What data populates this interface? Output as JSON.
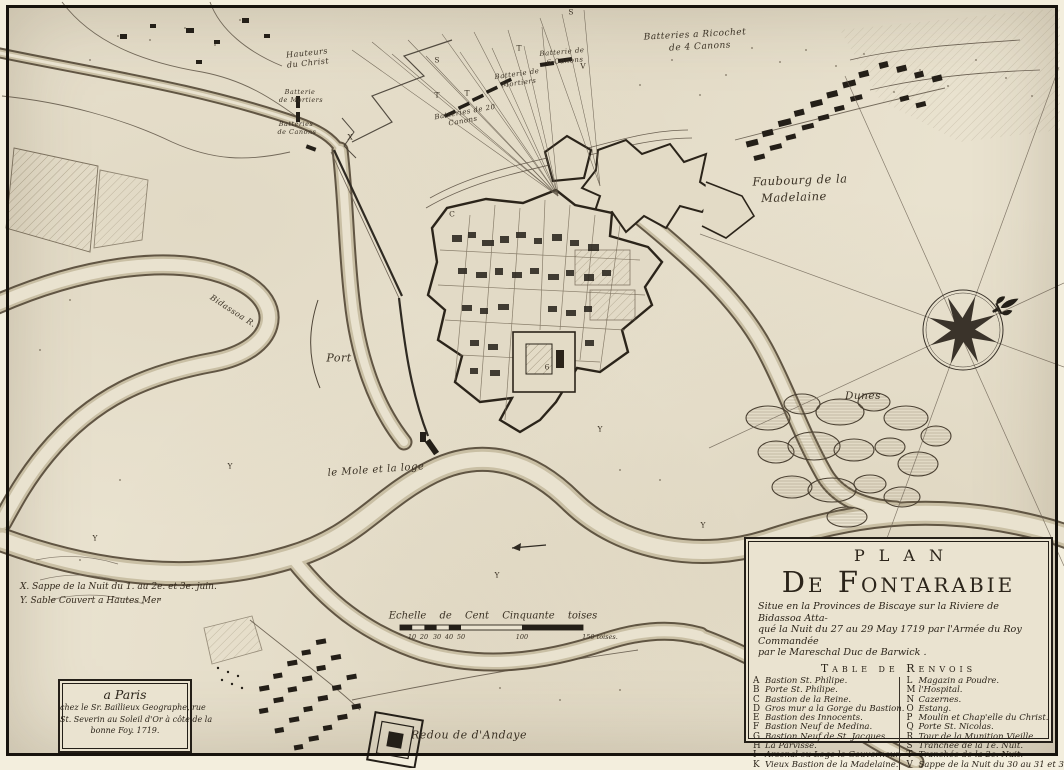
{
  "title_block": {
    "line1": "Plan",
    "line2": "De Fontarabie",
    "subtitle": [
      "Situe en la Provinces de Biscaye sur la Riviere de Bidassoa Atta-",
      "qué la Nuit du 27 au 29 May 1719 par l'Armée du Roy Commandée",
      "par le Mareschal Duc de Barwick ."
    ],
    "table_title": "Table de Renvois",
    "left_entries": [
      {
        "key": "A",
        "label": "Bastion St. Philipe."
      },
      {
        "key": "B",
        "label": "Porte St. Philipe."
      },
      {
        "key": "C",
        "label": "Bastion de la Reine."
      },
      {
        "key": "D",
        "label": "Gros mur a la Gorge du Bastion."
      },
      {
        "key": "E",
        "label": "Bastion des Innocents."
      },
      {
        "key": "F",
        "label": "Bastion Neuf de Medina."
      },
      {
        "key": "G",
        "label": "Bastion Neuf de St. Jacques."
      },
      {
        "key": "H",
        "label": "La Parvisse."
      },
      {
        "key": "I",
        "label": "Arsenal ou Loge le Gouverneur."
      },
      {
        "key": "K",
        "label": "Vieux Bastion de la Madelaine."
      }
    ],
    "right_entries": [
      {
        "key": "L",
        "label": "Magazin a Poudre."
      },
      {
        "key": "M",
        "label": "l'Hospital."
      },
      {
        "key": "N",
        "label": "Cazernes."
      },
      {
        "key": "O",
        "label": "Estang."
      },
      {
        "key": "P",
        "label": "Moulin et Chap'elle du Christ."
      },
      {
        "key": "Q",
        "label": "Porte St. Nicolas."
      },
      {
        "key": "R",
        "label": "Tour de la Munition Vieille."
      },
      {
        "key": "S",
        "label": "Tranchée de la 1e. Nuit."
      },
      {
        "key": "T",
        "label": "Tranchée de la 2e. Nuit."
      },
      {
        "key": "V",
        "label": "Sappe de la Nuit du 30 au 31 et 3 juin."
      }
    ]
  },
  "publisher_block": {
    "line1": "a Paris",
    "line2": "chez le Sr. Baillieux  Geographe, rue",
    "line3": "St. Severin au Soleil d'Or à côte de la",
    "line4": "bonne Foy. 1719."
  },
  "notes": {
    "x_note": "X. Sappe de la Nuit du 1. au 2e. et 3e. juin.",
    "y_note": "Y. Sable Couvert a Hautes Mer"
  },
  "scale_bar": {
    "label": "Echelle de Cent Cinquante toises",
    "ticks": [
      {
        "t": "10",
        "x": 412,
        "y": 633
      },
      {
        "t": "20",
        "x": 424,
        "y": 633
      },
      {
        "t": "30",
        "x": 437,
        "y": 633
      },
      {
        "t": "40",
        "x": 449,
        "y": 633
      },
      {
        "t": "50",
        "x": 461,
        "y": 633
      },
      {
        "t": "100",
        "x": 522,
        "y": 633
      },
      {
        "t": "150 toises.",
        "x": 600,
        "y": 633
      }
    ]
  },
  "map_labels": [
    {
      "text": "Batteries a Ricochet",
      "x": 695,
      "y": 35,
      "size": 9,
      "rot": -3
    },
    {
      "text": "de 4 Canons",
      "x": 700,
      "y": 47,
      "size": 9,
      "rot": -3
    },
    {
      "text": "Hauteurs",
      "x": 307,
      "y": 53,
      "size": 8,
      "rot": -6
    },
    {
      "text": "du Christ",
      "x": 308,
      "y": 63,
      "size": 8,
      "rot": -6
    },
    {
      "text": "Batterie",
      "x": 300,
      "y": 92,
      "size": 6.5,
      "rot": 0
    },
    {
      "text": "de Mortiers",
      "x": 301,
      "y": 100,
      "size": 6.5,
      "rot": 0
    },
    {
      "text": "Batteries",
      "x": 296,
      "y": 124,
      "size": 6.5,
      "rot": 0
    },
    {
      "text": "de Canons",
      "x": 297,
      "y": 132,
      "size": 6.5,
      "rot": 0
    },
    {
      "text": "Batterie de",
      "x": 562,
      "y": 52,
      "size": 7,
      "rot": -5
    },
    {
      "text": "6 Canons",
      "x": 565,
      "y": 61,
      "size": 7,
      "rot": -5
    },
    {
      "text": "Batterie de",
      "x": 517,
      "y": 74,
      "size": 7,
      "rot": -8
    },
    {
      "text": "Mortiers",
      "x": 519,
      "y": 83,
      "size": 7,
      "rot": -8
    },
    {
      "text": "Batteries de 20",
      "x": 465,
      "y": 112,
      "size": 7,
      "rot": -10
    },
    {
      "text": "Canons",
      "x": 463,
      "y": 121,
      "size": 7,
      "rot": -10
    },
    {
      "text": "Faubourg de la",
      "x": 800,
      "y": 180,
      "size": 11.5,
      "rot": -2
    },
    {
      "text": "Madelaine",
      "x": 794,
      "y": 197,
      "size": 11.5,
      "rot": -2
    },
    {
      "text": "Dunes",
      "x": 863,
      "y": 396,
      "size": 10.5,
      "rot": 0
    },
    {
      "text": "Port",
      "x": 339,
      "y": 358,
      "size": 11,
      "rot": 0
    },
    {
      "text": "le Mole et la loge",
      "x": 376,
      "y": 470,
      "size": 10,
      "rot": -4
    },
    {
      "text": "Bidassoa R.",
      "x": 233,
      "y": 311,
      "size": 8,
      "rot": 33
    },
    {
      "text": "Redou de d'Andaye",
      "x": 469,
      "y": 735,
      "size": 11,
      "rot": 0
    }
  ],
  "ref_letters": [
    {
      "t": "S",
      "x": 437,
      "y": 60
    },
    {
      "t": "T",
      "x": 519,
      "y": 48
    },
    {
      "t": "T",
      "x": 437,
      "y": 95
    },
    {
      "t": "T",
      "x": 467,
      "y": 93
    },
    {
      "t": "V",
      "x": 583,
      "y": 66
    },
    {
      "t": "S",
      "x": 571,
      "y": 12
    },
    {
      "t": "X",
      "x": 350,
      "y": 137
    },
    {
      "t": "C",
      "x": 452,
      "y": 214
    },
    {
      "t": "Y",
      "x": 600,
      "y": 429
    },
    {
      "t": "Y",
      "x": 497,
      "y": 575
    },
    {
      "t": "Y",
      "x": 703,
      "y": 525
    },
    {
      "t": "Y",
      "x": 230,
      "y": 466
    },
    {
      "t": "Y",
      "x": 95,
      "y": 538
    },
    {
      "t": "6",
      "x": 547,
      "y": 367
    }
  ],
  "colors": {
    "paper": "#e9e2cf",
    "ink": "#2b241a",
    "frame": "#17130d",
    "water_edge": "#5a4e3c",
    "water_tint": "#c9bfa4",
    "hatch": "#8a7c63"
  }
}
